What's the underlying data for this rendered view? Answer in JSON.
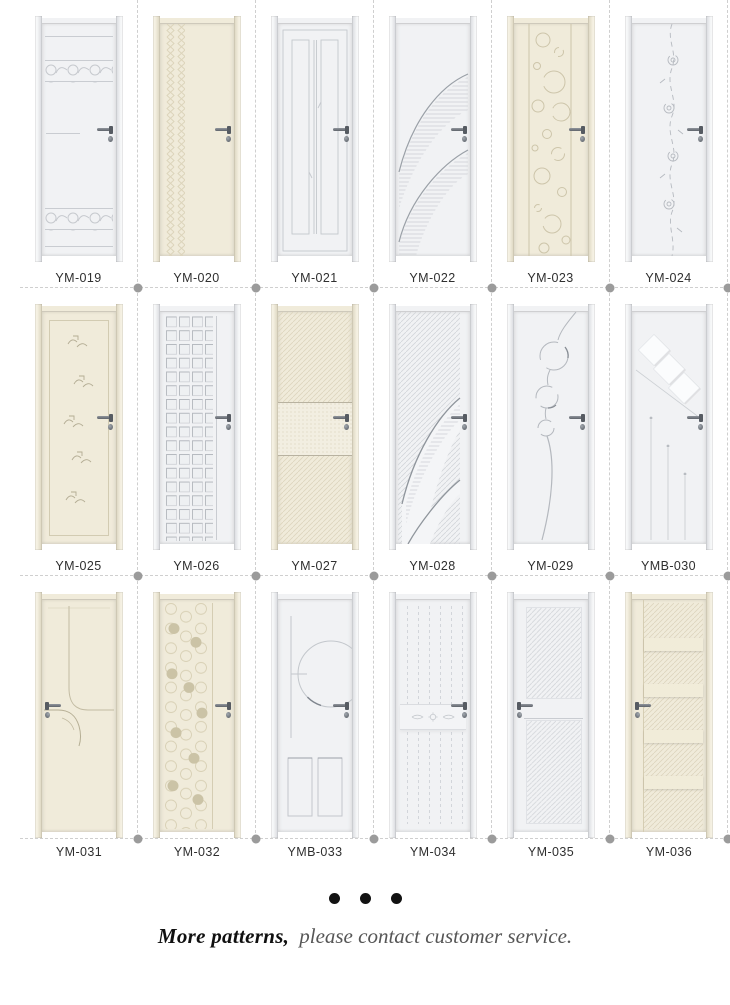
{
  "catalog": {
    "doors": [
      {
        "label": "YM-019",
        "tone": "white",
        "handle": "right",
        "pattern": "scroll-bands"
      },
      {
        "label": "YM-020",
        "tone": "cream",
        "handle": "right",
        "pattern": "braid-strip"
      },
      {
        "label": "YM-021",
        "tone": "white",
        "handle": "right",
        "pattern": "vertical-grooves"
      },
      {
        "label": "YM-022",
        "tone": "white",
        "handle": "right",
        "pattern": "sweep-curves-hatch"
      },
      {
        "label": "YM-023",
        "tone": "cream",
        "handle": "right",
        "pattern": "bubbles-panel"
      },
      {
        "label": "YM-024",
        "tone": "white",
        "handle": "right",
        "pattern": "floral-vine"
      },
      {
        "label": "YM-025",
        "tone": "cream",
        "handle": "right",
        "pattern": "panel-bird-motifs"
      },
      {
        "label": "YM-026",
        "tone": "white",
        "handle": "right",
        "pattern": "square-grid"
      },
      {
        "label": "YM-027",
        "tone": "cream",
        "handle": "right",
        "pattern": "diagonal-hatch-band"
      },
      {
        "label": "YM-028",
        "tone": "white",
        "handle": "right",
        "pattern": "hatch-sweep-curves"
      },
      {
        "label": "YM-029",
        "tone": "white",
        "handle": "right",
        "pattern": "circle-chain"
      },
      {
        "label": "YMB-030",
        "tone": "white",
        "handle": "right",
        "pattern": "diamonds-lines"
      },
      {
        "label": "YM-031",
        "tone": "cream",
        "handle": "left",
        "pattern": "branch-curve"
      },
      {
        "label": "YM-032",
        "tone": "cream",
        "handle": "right",
        "pattern": "dot-circles-column"
      },
      {
        "label": "YMB-033",
        "tone": "white",
        "handle": "right",
        "pattern": "arc-panels"
      },
      {
        "label": "YM-034",
        "tone": "white",
        "handle": "right",
        "pattern": "planks-carved-band"
      },
      {
        "label": "YM-035",
        "tone": "white",
        "handle": "left",
        "pattern": "hatch-two-panels"
      },
      {
        "label": "YM-036",
        "tone": "cream",
        "handle": "left",
        "pattern": "hatch-ladder-bands"
      }
    ]
  },
  "footer": {
    "ellipsis_dots": 3,
    "more": "More patterns,",
    "contact": "please contact customer service."
  },
  "colors": {
    "page_bg": "#ffffff",
    "white_door": "#f1f2f4",
    "cream_door": "#f0ebda",
    "line_on_white": "#c9ccd1",
    "line_on_cream": "#d5cdb3",
    "dash_line": "#cfcfcf",
    "separator_dot": "#9b9b9b",
    "label_text": "#2f2f2f",
    "footer_bold": "#101010",
    "footer_muted": "#565656",
    "handle_metal": "#5f646b"
  }
}
